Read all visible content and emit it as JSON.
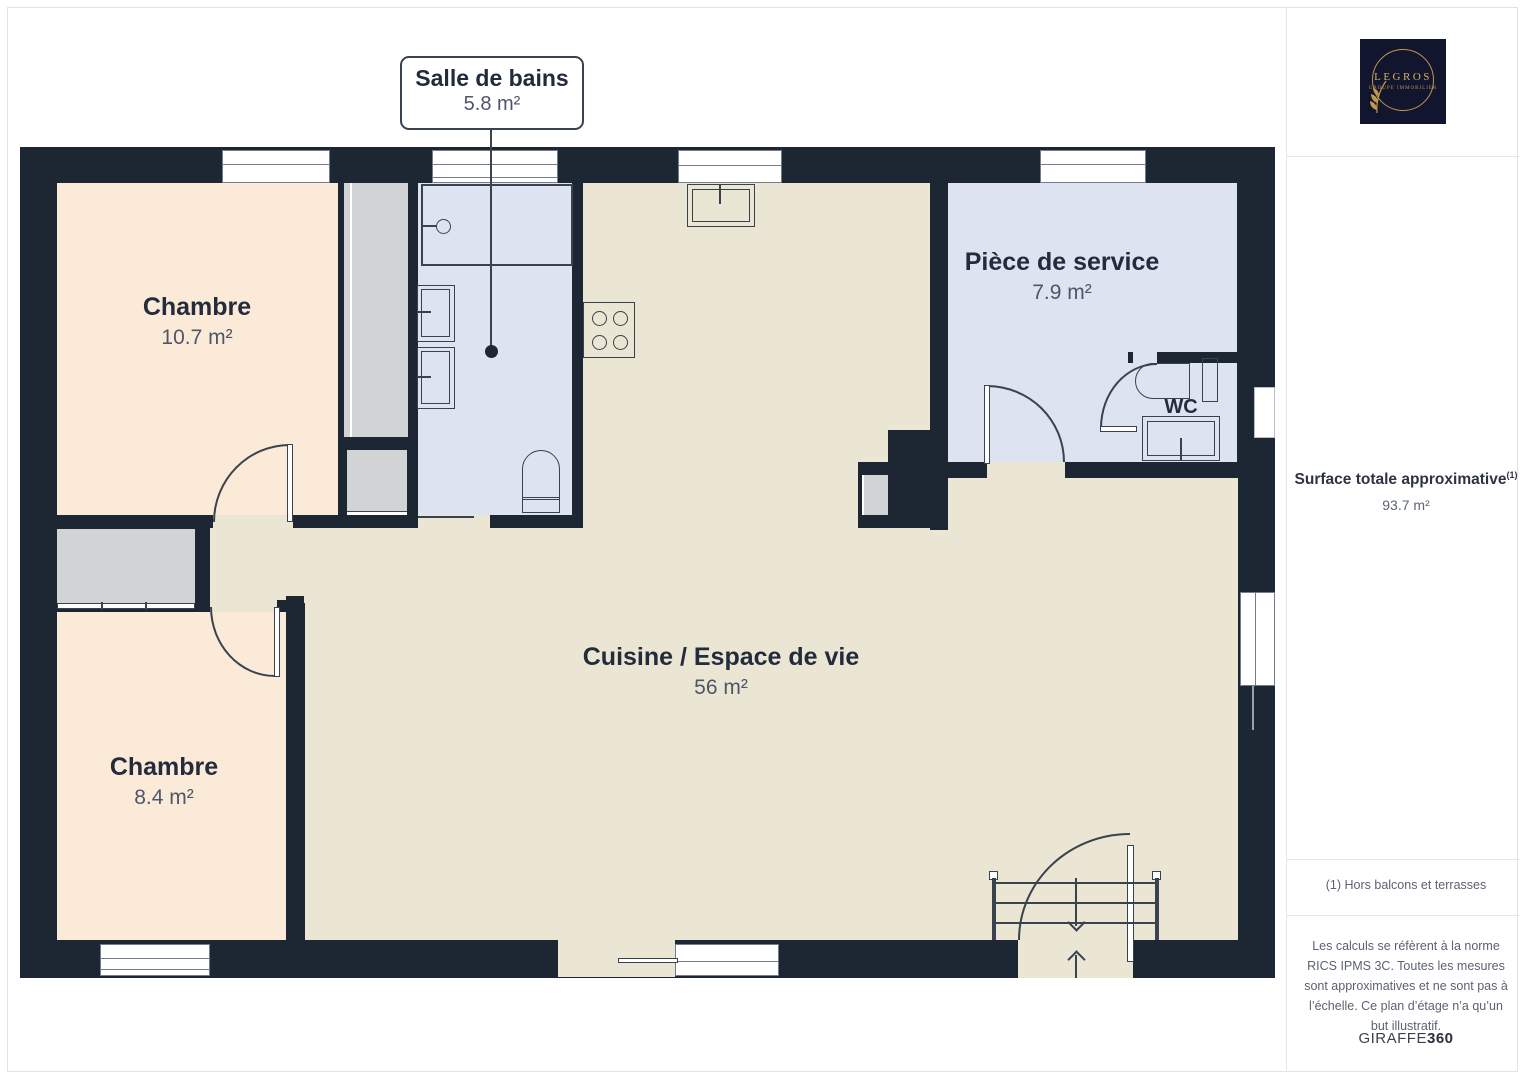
{
  "page": {
    "background": "#ffffff",
    "frame_color": "#e2e3e6"
  },
  "plan": {
    "colors": {
      "wall": "#1d2734",
      "bedroom_fill": "#fcead9",
      "living_fill": "#ebe6d3",
      "wet_room_fill": "#dde3f0",
      "closet_fill": "#d2d3d4",
      "stroke": "#39424f",
      "label_text": "#232c3c",
      "area_text": "#4d5768"
    },
    "callout": {
      "title": "Salle de bains",
      "area": "5.8 m²"
    },
    "rooms": [
      {
        "name": "Chambre",
        "area": "10.7 m²"
      },
      {
        "name": "Pièce de service",
        "area": "7.9 m²"
      },
      {
        "name": "WC",
        "area": ""
      },
      {
        "name": "Cuisine / Espace de vie",
        "area": "56 m²"
      },
      {
        "name": "Chambre",
        "area": "8.4 m²"
      }
    ]
  },
  "sidebar": {
    "logo": {
      "brand": "LEGROS",
      "tagline": "GROUPE IMMOBILIER",
      "background": "#12152e",
      "gold": "#c0984f"
    },
    "surface": {
      "title": "Surface totale approximative",
      "footnote_marker": "(1)",
      "value": "93.7 m²"
    },
    "footnote": "(1) Hors balcons et terrasses",
    "disclaimer": "Les calculs se réfèrent à la norme RICS IPMS 3C. Toutes les mesures sont approximatives et ne sont pas à l’échelle. Ce plan d’étage n’a qu’un but illustratif.",
    "brand": {
      "name": "GIRAFFE",
      "suffix": "360"
    }
  }
}
